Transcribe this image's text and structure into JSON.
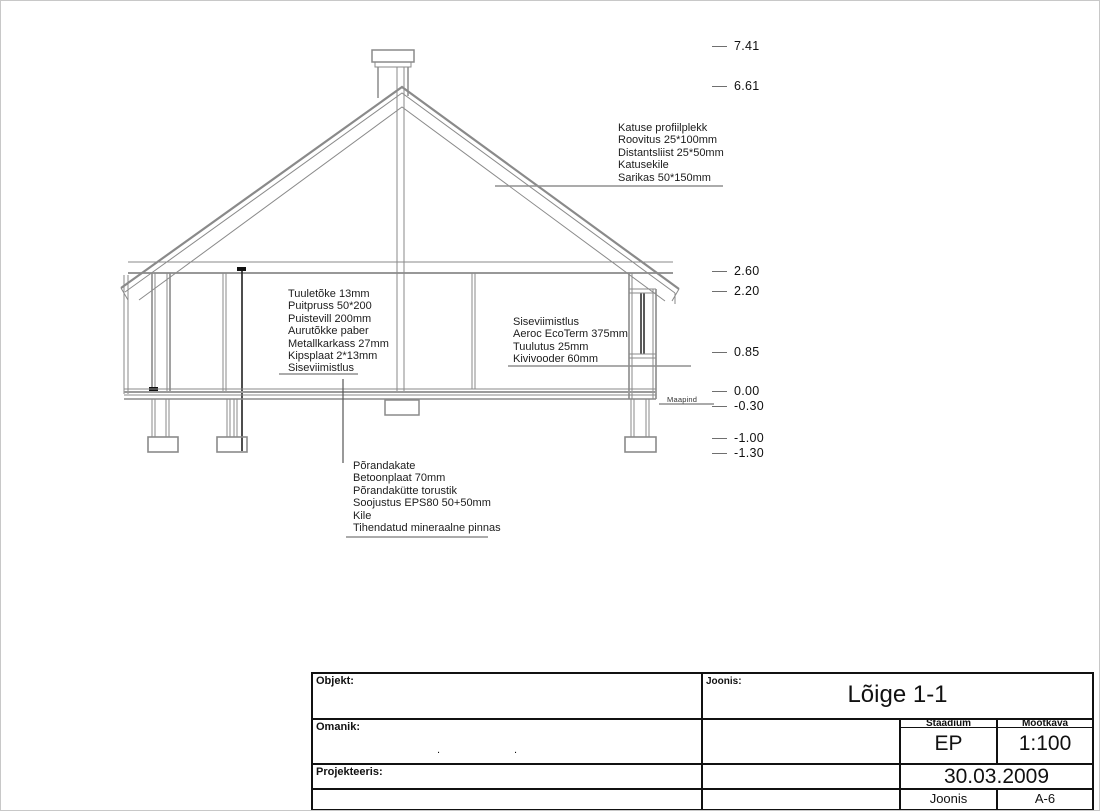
{
  "drawing": {
    "type": "building-cross-section",
    "elevation_markers": [
      "7.41",
      "6.61",
      "2.60",
      "2.20",
      "0.85",
      "0.00",
      "-0.30",
      "-1.00",
      "-1.30"
    ],
    "ground_label": "Maapind",
    "annotations": {
      "roof": {
        "lines": [
          "Katuse profiilplekk",
          "Roovitus 25*100mm",
          "Distantsliist 25*50mm",
          "Katusekile",
          "Sarikas 50*150mm"
        ]
      },
      "left_wall": {
        "lines": [
          "Tuuletõke 13mm",
          "Puitpruss 50*200",
          "Puistevill 200mm",
          "Aurutõkke paber",
          "Metallkarkass 27mm",
          "Kipsplaat 2*13mm",
          "Siseviimistlus"
        ]
      },
      "right_wall": {
        "lines": [
          "Siseviimistlus",
          "Aeroc EcoTerm 375mm",
          "Tuulutus 25mm",
          "Kivivooder 60mm"
        ]
      },
      "floor": {
        "lines": [
          "Põrandakate",
          "Betoonplaat 70mm",
          "Põrandakütte torustik",
          "Soojustus EPS80 50+50mm",
          "Kile",
          "Tihendatud mineraalne pinnas"
        ]
      }
    }
  },
  "title_block": {
    "objekt_label": "Objekt:",
    "omanik_label": "Omanik:",
    "projekteeris_label": "Projekteeris:",
    "joonis_label": "Joonis:",
    "drawing_title": "Lõige 1-1",
    "staadium_label": "Staadium",
    "staadium_value": "EP",
    "mootkava_label": "Mõõtkava",
    "mootkava_value": "1:100",
    "date": "30.03.2009",
    "joonis_footer_label": "Joonis",
    "sheet_number": "A-6",
    "omanik_punctuation": [
      ".",
      "."
    ]
  },
  "colors": {
    "line_gray": "#8a8a8a",
    "line_dark": "#1c1c1c",
    "leader_gray": "#8f8f8f"
  }
}
